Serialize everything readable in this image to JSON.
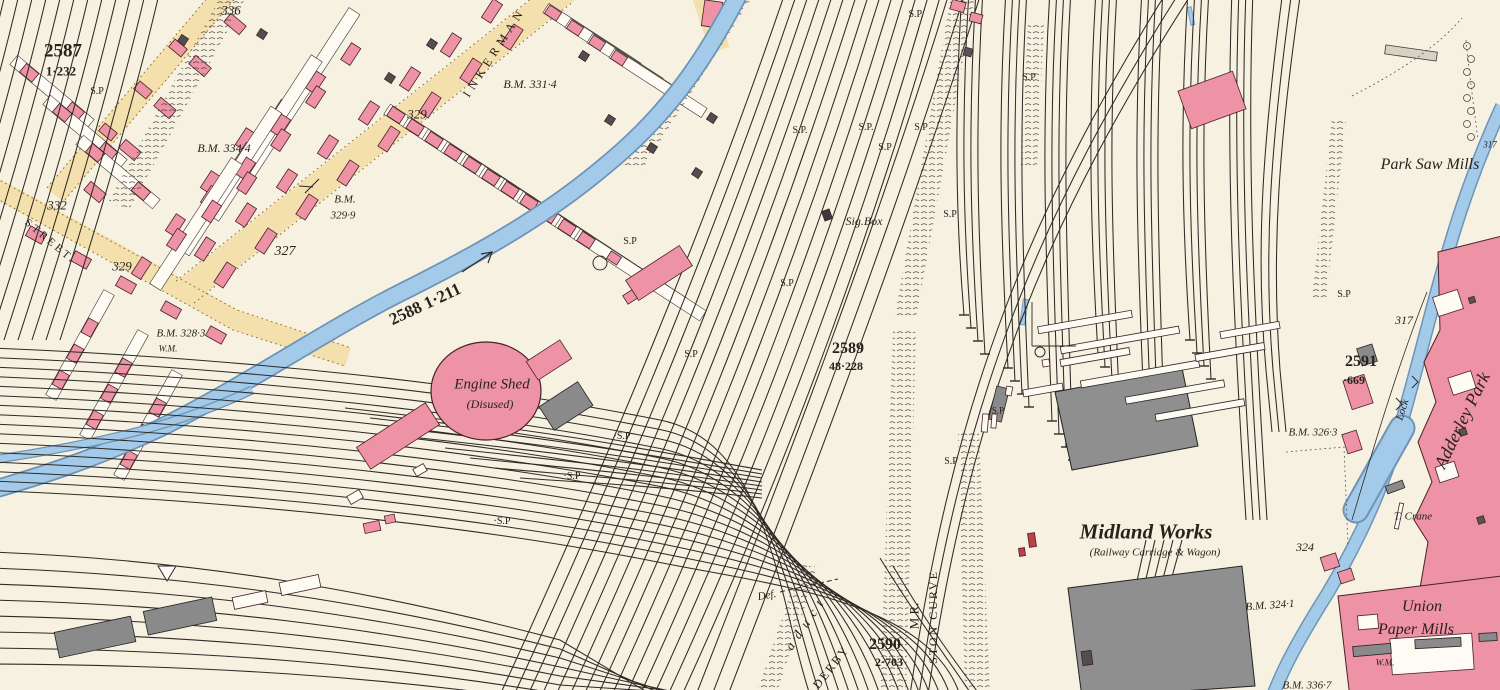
{
  "map": {
    "colors": {
      "paper": "#f7f1e1",
      "building_pink": "#ee92a6",
      "building_pink_edge": "#4a2028",
      "building_grey": "#8a8a8a",
      "water_blue": "#a3cbe9",
      "water_edge": "#6d94b8",
      "road_buff": "#f4e0ac",
      "road_dot": "#8a6a33",
      "line_ink": "#2e2a26"
    },
    "labels": [
      {
        "text": "2587",
        "name": "parcel-2587",
        "x": 63,
        "y": 51,
        "s": 19,
        "b": true
      },
      {
        "text": "1·232",
        "name": "parcel-2587-area",
        "x": 61,
        "y": 71,
        "s": 13,
        "b": true
      },
      {
        "text": "S.P",
        "name": "sp-marker",
        "x": 97,
        "y": 92,
        "s": 10
      },
      {
        "text": "336",
        "name": "plot-336",
        "x": 231,
        "y": 10,
        "s": 13,
        "i": true
      },
      {
        "text": "B.M. 334·4",
        "name": "benchmark-334-4",
        "x": 224,
        "y": 148,
        "s": 12,
        "i": true
      },
      {
        "text": "329",
        "name": "plot-329-upper",
        "x": 417,
        "y": 114,
        "s": 13,
        "i": true
      },
      {
        "text": "INKERMAN",
        "name": "street-inkerman",
        "x": 494,
        "y": 52,
        "s": 12,
        "r": -57,
        "sp": 5
      },
      {
        "text": "B.M. 331·4",
        "name": "benchmark-331-4",
        "x": 530,
        "y": 84,
        "s": 12,
        "i": true
      },
      {
        "text": "332",
        "name": "plot-332",
        "x": 57,
        "y": 205,
        "s": 13,
        "i": true
      },
      {
        "text": "STREET.",
        "name": "street-label",
        "x": 50,
        "y": 242,
        "s": 11,
        "r": 40,
        "sp": 3
      },
      {
        "text": "329",
        "name": "plot-329-lower",
        "x": 122,
        "y": 266,
        "s": 13,
        "i": true
      },
      {
        "text": "327",
        "name": "plot-327",
        "x": 285,
        "y": 252,
        "s": 14,
        "i": true
      },
      {
        "text": "B.M.",
        "name": "benchmark-329-9-a",
        "x": 345,
        "y": 200,
        "s": 11,
        "i": true
      },
      {
        "text": "329·9",
        "name": "benchmark-329-9-b",
        "x": 343,
        "y": 216,
        "s": 11,
        "i": true
      },
      {
        "text": "B.M. 328·3",
        "name": "benchmark-328-3",
        "x": 181,
        "y": 334,
        "s": 11,
        "i": true
      },
      {
        "text": "W.M.",
        "name": "wm-left",
        "x": 168,
        "y": 349,
        "s": 9,
        "i": true
      },
      {
        "text": "2588  1·211",
        "name": "parcel-2588",
        "x": 425,
        "y": 304,
        "s": 17,
        "b": true,
        "r": -25
      },
      {
        "text": "Engine Shed",
        "name": "engine-shed-label",
        "x": 492,
        "y": 385,
        "s": 15,
        "i": true
      },
      {
        "text": "(Disused)",
        "name": "engine-shed-disused",
        "x": 490,
        "y": 404,
        "s": 12,
        "i": true
      },
      {
        "text": "Sig.Box",
        "name": "signal-box-label",
        "x": 864,
        "y": 221,
        "s": 12,
        "i": true
      },
      {
        "text": "2589",
        "name": "parcel-2589",
        "x": 848,
        "y": 349,
        "s": 16,
        "b": true
      },
      {
        "text": "48·228",
        "name": "parcel-2589-area",
        "x": 846,
        "y": 366,
        "s": 12,
        "b": true
      },
      {
        "text": "S.P.",
        "name": "sp-marker",
        "x": 916,
        "y": 15,
        "s": 10
      },
      {
        "text": "S.P",
        "name": "sp-marker",
        "x": 1029,
        "y": 78,
        "s": 10
      },
      {
        "text": "S.P.",
        "name": "sp-marker",
        "x": 800,
        "y": 131,
        "s": 10
      },
      {
        "text": "S.P.",
        "name": "sp-marker",
        "x": 866,
        "y": 128,
        "s": 10
      },
      {
        "text": "S.P",
        "name": "sp-marker",
        "x": 921,
        "y": 128,
        "s": 10
      },
      {
        "text": "S.P",
        "name": "sp-marker",
        "x": 885,
        "y": 148,
        "s": 10
      },
      {
        "text": "S.P",
        "name": "sp-marker",
        "x": 950,
        "y": 215,
        "s": 10
      },
      {
        "text": "S.P",
        "name": "sp-marker",
        "x": 630,
        "y": 242,
        "s": 10
      },
      {
        "text": "S.P",
        "name": "sp-marker",
        "x": 787,
        "y": 284,
        "s": 10
      },
      {
        "text": "S.P",
        "name": "sp-marker",
        "x": 691,
        "y": 355,
        "s": 10
      },
      {
        "text": "S.P",
        "name": "sp-marker",
        "x": 998,
        "y": 411,
        "s": 9
      },
      {
        "text": "S.P",
        "name": "sp-marker",
        "x": 951,
        "y": 462,
        "s": 10
      },
      {
        "text": "·S.P",
        "name": "sp-marker",
        "x": 622,
        "y": 437,
        "s": 10
      },
      {
        "text": "·S.P",
        "name": "sp-marker",
        "x": 572,
        "y": 477,
        "s": 10
      },
      {
        "text": "·S.P",
        "name": "sp-marker",
        "x": 502,
        "y": 522,
        "s": 10
      },
      {
        "text": "S.P",
        "name": "sp-marker",
        "x": 1344,
        "y": 295,
        "s": 10
      },
      {
        "text": "Park Saw Mills",
        "name": "park-saw-mills",
        "x": 1430,
        "y": 165,
        "s": 16,
        "i": true
      },
      {
        "text": "317",
        "name": "plot-317-top",
        "x": 1490,
        "y": 145,
        "s": 9,
        "i": true
      },
      {
        "text": "317",
        "name": "plot-317",
        "x": 1404,
        "y": 320,
        "s": 12,
        "i": true
      },
      {
        "text": "2591",
        "name": "parcel-2591",
        "x": 1361,
        "y": 362,
        "s": 16,
        "b": true
      },
      {
        "text": "·669",
        "name": "parcel-2591-area",
        "x": 1354,
        "y": 380,
        "s": 12,
        "b": true
      },
      {
        "text": "Lock",
        "name": "lock-label",
        "x": 1403,
        "y": 410,
        "s": 11,
        "i": true,
        "r": -72
      },
      {
        "text": "B.M. 326·3",
        "name": "benchmark-326-3",
        "x": 1313,
        "y": 433,
        "s": 11,
        "i": true
      },
      {
        "text": "T. Crane",
        "name": "crane-label",
        "x": 1413,
        "y": 517,
        "s": 11,
        "i": true
      },
      {
        "text": "324",
        "name": "plot-324",
        "x": 1305,
        "y": 547,
        "s": 12,
        "i": true
      },
      {
        "text": "Adderley Park",
        "name": "adderley-park",
        "x": 1462,
        "y": 420,
        "s": 18,
        "i": true,
        "r": -64
      },
      {
        "text": "Midland Works",
        "name": "midland-works",
        "x": 1146,
        "y": 532,
        "s": 21,
        "i": true,
        "b": true
      },
      {
        "text": "(Railway Carriage & Wagon)",
        "name": "midland-works-sub",
        "x": 1155,
        "y": 553,
        "s": 11,
        "i": true
      },
      {
        "text": "B.M. 324·1",
        "name": "benchmark-324-1",
        "x": 1270,
        "y": 606,
        "s": 11,
        "i": true,
        "r": -4
      },
      {
        "text": "Union",
        "name": "union-paper-mills-a",
        "x": 1422,
        "y": 607,
        "s": 16,
        "i": true
      },
      {
        "text": "Paper Mills",
        "name": "union-paper-mills-b",
        "x": 1416,
        "y": 630,
        "s": 16,
        "i": true
      },
      {
        "text": "W.M.",
        "name": "wm-right",
        "x": 1385,
        "y": 663,
        "s": 9,
        "i": true
      },
      {
        "text": "B.M. 336·7",
        "name": "benchmark-336-7",
        "x": 1307,
        "y": 686,
        "s": 11,
        "i": true
      },
      {
        "text": "2590",
        "name": "parcel-2590",
        "x": 885,
        "y": 645,
        "s": 16,
        "b": true
      },
      {
        "text": "2·703",
        "name": "parcel-2590-area",
        "x": 889,
        "y": 662,
        "s": 12,
        "b": true
      },
      {
        "text": "M.R.",
        "name": "railway-mr",
        "x": 914,
        "y": 616,
        "s": 13,
        "r": -90
      },
      {
        "text": "STON CURVE",
        "name": "railway-ston-curve",
        "x": 933,
        "y": 617,
        "s": 12,
        "r": -90,
        "sp": 2
      },
      {
        "text": "DERBY",
        "name": "railway-derby",
        "x": 831,
        "y": 667,
        "s": 12,
        "r": -52,
        "sp": 2
      },
      {
        "text": "aduct",
        "name": "viaduct-label",
        "x": 806,
        "y": 622,
        "s": 13,
        "i": true,
        "r": -56,
        "sp": 7
      },
      {
        "text": "Def.",
        "name": "def-label",
        "x": 767,
        "y": 596,
        "s": 11,
        "i": true,
        "r": -10
      }
    ]
  }
}
